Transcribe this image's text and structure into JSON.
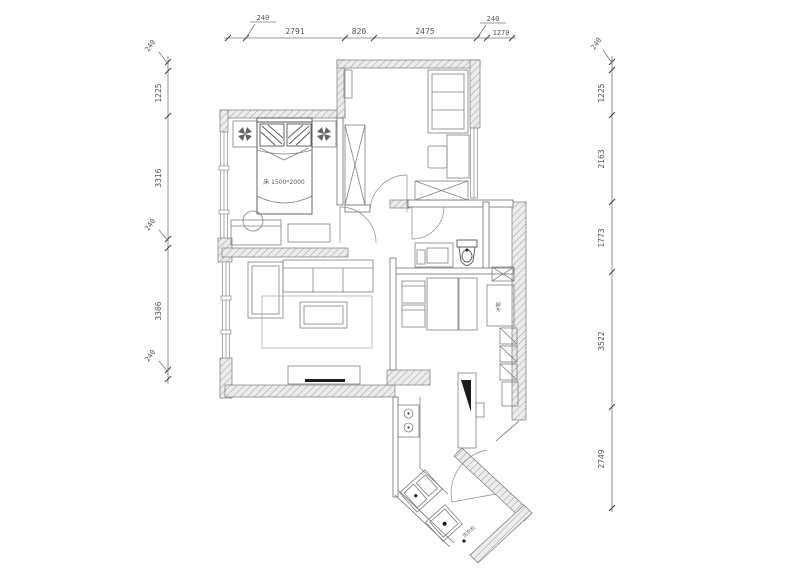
{
  "drawing": {
    "type": "apartment-floor-plan",
    "style": "CAD line drawing, monochrome gray on white"
  },
  "dimensions": {
    "top": {
      "segments": [
        "240",
        "2791",
        "820",
        "2475",
        "240",
        "1270"
      ]
    },
    "left": {
      "segments": [
        "240",
        "1225",
        "3316",
        "240",
        "3306",
        "240"
      ]
    },
    "right": {
      "segments": [
        "240",
        "1225",
        "2163",
        "1773",
        "3522",
        "2749"
      ]
    }
  },
  "plan": {
    "labels": {
      "bed": "床 1500*2000",
      "washer": "洗衣机",
      "fridge": "冰箱"
    }
  },
  "colors": {
    "line": "#777777",
    "dark": "#1c1c1c",
    "wall_hatch": "#9c9c9c",
    "background": "#ffffff"
  }
}
